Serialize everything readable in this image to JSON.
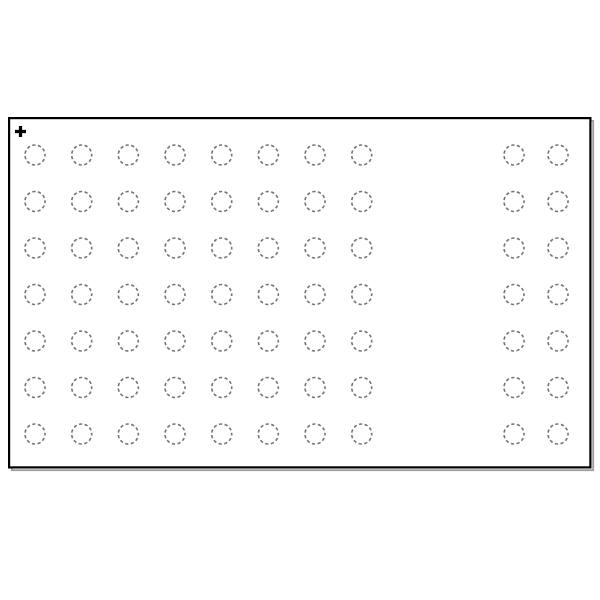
{
  "diagram": {
    "kind": "pcb-footprint-land-pattern",
    "canvas": {
      "width": 600,
      "height": 600,
      "background_color": "#ffffff"
    },
    "outline": {
      "x": 8,
      "y": 117,
      "width": 583.5,
      "height": 351.5,
      "stroke_color": "#000000",
      "stroke_width": 2.2,
      "fill_color": "#ffffff",
      "shadow_color": "#9c9c9c",
      "shadow_stroke_width": 1.8,
      "shadow_offset_x": 2.8,
      "shadow_offset_y": 2.8
    },
    "origin_marker": {
      "glyph": "+",
      "x": 20.5,
      "y": 131.5,
      "arm_length": 5.5,
      "stroke_width": 3.2,
      "color": "#000000"
    },
    "pads": {
      "shape": "dashed-circle",
      "radius": 10,
      "stroke_color": "#737373",
      "stroke_width": 1.6,
      "dash_array": "3.2 2.51",
      "fill": "none",
      "row_ys": [
        155,
        201.5,
        248,
        294.5,
        341,
        387.5,
        434
      ],
      "left_column_xs": [
        35,
        81.7,
        128.3,
        175,
        221.7,
        268.3,
        315,
        361.7
      ],
      "right_column_xs": [
        514,
        558
      ],
      "row_count": 7,
      "left_column_count": 8,
      "right_column_count": 2,
      "pad_count": 70
    }
  }
}
